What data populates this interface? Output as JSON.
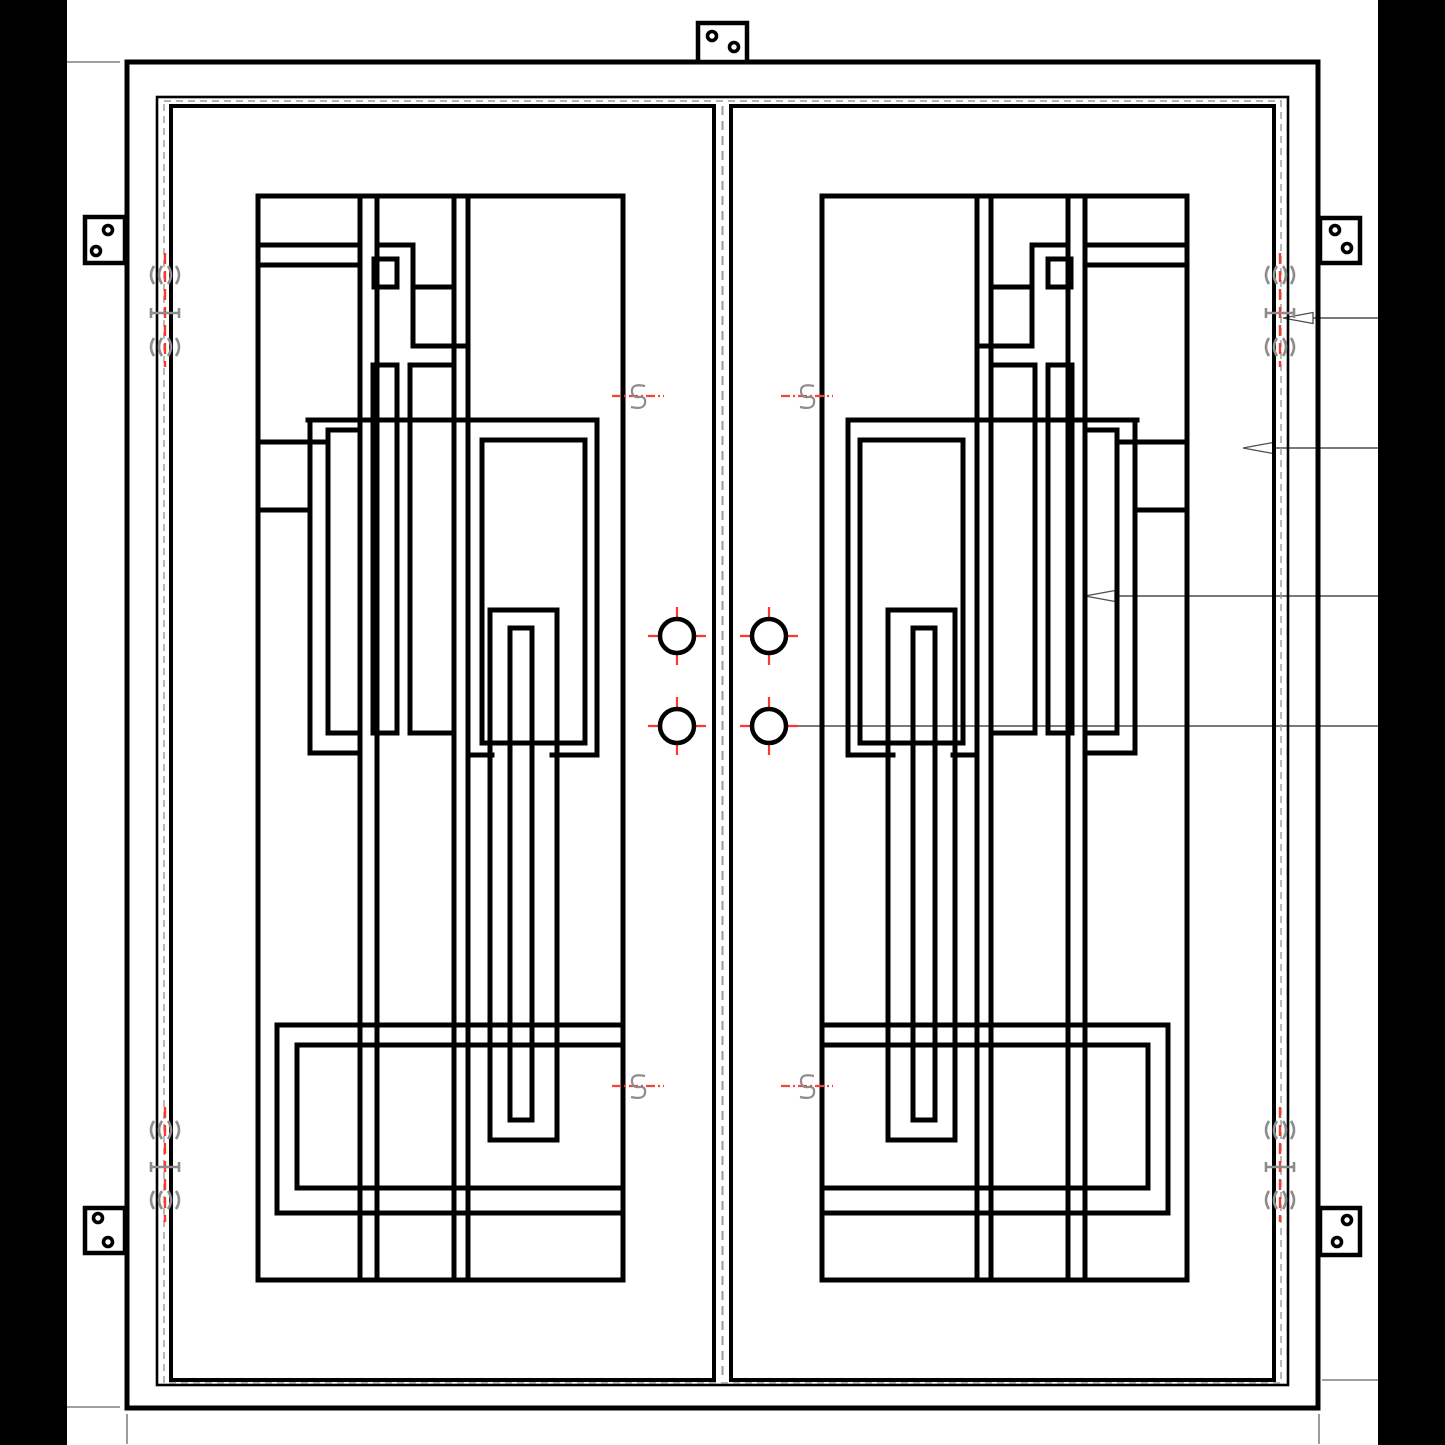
{
  "document": {
    "type": "cad-shop-drawing",
    "subject": "double-iron-entry-door-front-elevation"
  },
  "canvas": {
    "width": 1445,
    "height": 1445,
    "background": "#ffffff"
  },
  "colors": {
    "line": "#000000",
    "red": "#f93a2f",
    "marker_red": "#f4453a",
    "gray": "#8c8c8c",
    "dash_gray": "#9a9a9a",
    "leader": "#4d4d4d",
    "extension": "#666666",
    "bar": "#000000",
    "paper": "#ffffff"
  },
  "side_bars": [
    {
      "name": "black-border-left",
      "x": 0,
      "y": 0,
      "w": 67,
      "h": 1445
    },
    {
      "name": "black-border-right",
      "x": 1378,
      "y": 0,
      "w": 67,
      "h": 1445
    }
  ],
  "frame": {
    "outer": {
      "x": 127,
      "y": 62,
      "w": 1191,
      "h": 1346,
      "sw": 5
    },
    "jamb": {
      "x": 157,
      "y": 97,
      "w": 1131,
      "h": 1288,
      "sw": 2.6
    },
    "gasket": {
      "x": 164,
      "y": 101,
      "w": 1117,
      "h": 1282,
      "sw": 1.4,
      "dash": "7 5"
    }
  },
  "leaves": {
    "left": {
      "x": 171,
      "y": 106,
      "w": 543,
      "h": 1274,
      "sw": 4
    },
    "right": {
      "x": 731,
      "y": 106,
      "w": 543,
      "h": 1274,
      "sw": 4
    },
    "gap_centerline": {
      "x": 722.5,
      "y1": 106,
      "y2": 1380,
      "dash": "9 6",
      "sw": 2
    }
  },
  "grille": {
    "stroke": 5,
    "mirror_width": 1445,
    "segments": [
      {
        "name": "border",
        "d": "M258,196 H623 V1280 H258 Z"
      },
      {
        "name": "stile-v1",
        "d": "M360,196 V1280"
      },
      {
        "name": "stile-v2",
        "d": "M377,196 V1280"
      },
      {
        "name": "stile-v3",
        "d": "M454,196 V1280"
      },
      {
        "name": "stile-v4",
        "d": "M468,196 V1280"
      },
      {
        "name": "top-rail-1",
        "d": "M258,245 H360"
      },
      {
        "name": "top-rail-2",
        "d": "M258,265 H360"
      },
      {
        "name": "stair-h1",
        "d": "M377,245 H413"
      },
      {
        "name": "stair-v",
        "d": "M413,245 V346"
      },
      {
        "name": "stair-h2",
        "d": "M413,287 H452"
      },
      {
        "name": "stair-h3",
        "d": "M413,346 H468"
      },
      {
        "name": "small-square",
        "d": "M374,259 h23 v28 h-23 Z"
      },
      {
        "name": "narrow-pane",
        "d": "M373,365 h24 v368 h-24 Z"
      },
      {
        "name": "mid-pane",
        "d": "M410,365 h44 v368 h-44 Z"
      },
      {
        "name": "tall-rect",
        "d": "M328,430 h32 v303 h-32 Z"
      },
      {
        "name": "cross-rail",
        "d": "M308,420 H597"
      },
      {
        "name": "cross-v-left",
        "d": "M310,420 V753"
      },
      {
        "name": "left-rail-1",
        "d": "M258,442 H328"
      },
      {
        "name": "left-rail-2",
        "d": "M258,510 H310"
      },
      {
        "name": "jog-h",
        "d": "M310,753 H360"
      },
      {
        "name": "big-box-right",
        "d": "M597,420 V755"
      },
      {
        "name": "big-box-inner",
        "d": "M482,440 H585 V743 H482 Z"
      },
      {
        "name": "big-box-bot-a",
        "d": "M468,755 H492"
      },
      {
        "name": "big-box-bot-b",
        "d": "M552,755 H597"
      },
      {
        "name": "slot-outer",
        "d": "M490,610 H557 V1140 H490 Z"
      },
      {
        "name": "slot-inner",
        "d": "M510,628 H532 V1120 H510 Z"
      },
      {
        "name": "bottom-rail-1",
        "d": "M277,1025 H623"
      },
      {
        "name": "bottom-v1",
        "d": "M277,1025 V1213"
      },
      {
        "name": "bottom-rail-2",
        "d": "M297,1045 H623"
      },
      {
        "name": "bottom-v2",
        "d": "M297,1045 V1188"
      },
      {
        "name": "bottom-rail-3",
        "d": "M297,1188 H623"
      },
      {
        "name": "bottom-rail-4",
        "d": "M277,1213 H623"
      }
    ]
  },
  "handles": {
    "radius": 17,
    "ring_stroke": 4.5,
    "cross_extent": 29,
    "cross_stroke": 2.2,
    "holes": [
      {
        "x": 677,
        "y": 636
      },
      {
        "x": 769,
        "y": 636
      },
      {
        "x": 677,
        "y": 726
      },
      {
        "x": 769,
        "y": 726
      }
    ]
  },
  "hinges": [
    {
      "name": "hinge-left-top",
      "x": 165,
      "y1": 253,
      "y2": 367,
      "knuckles": [
        275,
        313,
        347
      ]
    },
    {
      "name": "hinge-left-bottom",
      "x": 165,
      "y1": 1107,
      "y2": 1222,
      "knuckles": [
        1130,
        1167,
        1200
      ]
    },
    {
      "name": "hinge-right-top",
      "x": 1280,
      "y1": 253,
      "y2": 367,
      "knuckles": [
        275,
        313,
        347
      ]
    },
    {
      "name": "hinge-right-bottom",
      "x": 1280,
      "y1": 1107,
      "y2": 1222,
      "knuckles": [
        1130,
        1167,
        1200
      ]
    }
  ],
  "brackets": [
    {
      "name": "mounting-tab-top-center",
      "x": 698,
      "y": 23,
      "w": 49,
      "h": 39,
      "holes": [
        [
          712,
          36
        ],
        [
          734,
          47
        ]
      ]
    },
    {
      "name": "mounting-tab-left-top",
      "x": 85,
      "y": 217,
      "w": 40,
      "h": 46,
      "holes": [
        [
          108,
          230
        ],
        [
          96,
          251
        ]
      ]
    },
    {
      "name": "mounting-tab-left-bottom",
      "x": 85,
      "y": 1208,
      "w": 40,
      "h": 45,
      "holes": [
        [
          98,
          1218
        ],
        [
          108,
          1242
        ]
      ]
    },
    {
      "name": "mounting-tab-right-top",
      "x": 1320,
      "y": 218,
      "w": 40,
      "h": 45,
      "holes": [
        [
          1335,
          230
        ],
        [
          1347,
          248
        ]
      ]
    },
    {
      "name": "mounting-tab-right-bottom",
      "x": 1320,
      "y": 1208,
      "w": 40,
      "h": 47,
      "holes": [
        [
          1347,
          1220
        ],
        [
          1337,
          1242
        ]
      ]
    }
  ],
  "leaders": [
    {
      "name": "leader-hinge",
      "y": 318,
      "tip_x": 1283,
      "tail_x": 1378,
      "arrow": true
    },
    {
      "name": "leader-door-frame",
      "y": 448,
      "tip_x": 1243,
      "tail_x": 1378,
      "arrow": true
    },
    {
      "name": "leader-grille",
      "y": 596,
      "tip_x": 1085,
      "tail_x": 1378,
      "arrow": true
    },
    {
      "name": "leader-handle",
      "y": 726,
      "tip_x": 786,
      "tail_x": 1378,
      "arrow": false
    }
  ],
  "extension_lines": [
    {
      "name": "ext-top-left-h",
      "x1": 67,
      "y1": 62,
      "x2": 120,
      "y2": 62
    },
    {
      "name": "ext-bottom-left-h",
      "x1": 67,
      "y1": 1407,
      "x2": 120,
      "y2": 1407
    },
    {
      "name": "ext-bottom-left-v",
      "x1": 127,
      "y1": 1414,
      "x2": 127,
      "y2": 1444
    },
    {
      "name": "ext-bottom-right-h",
      "x1": 1322,
      "y1": 1380,
      "x2": 1378,
      "y2": 1380
    },
    {
      "name": "ext-bottom-right-v",
      "x1": 1319,
      "y1": 1414,
      "x2": 1319,
      "y2": 1444
    }
  ],
  "centerline_markers": [
    {
      "x": 638,
      "y": 396
    },
    {
      "x": 807,
      "y": 396
    },
    {
      "x": 638,
      "y": 1086
    },
    {
      "x": 807,
      "y": 1086
    }
  ]
}
